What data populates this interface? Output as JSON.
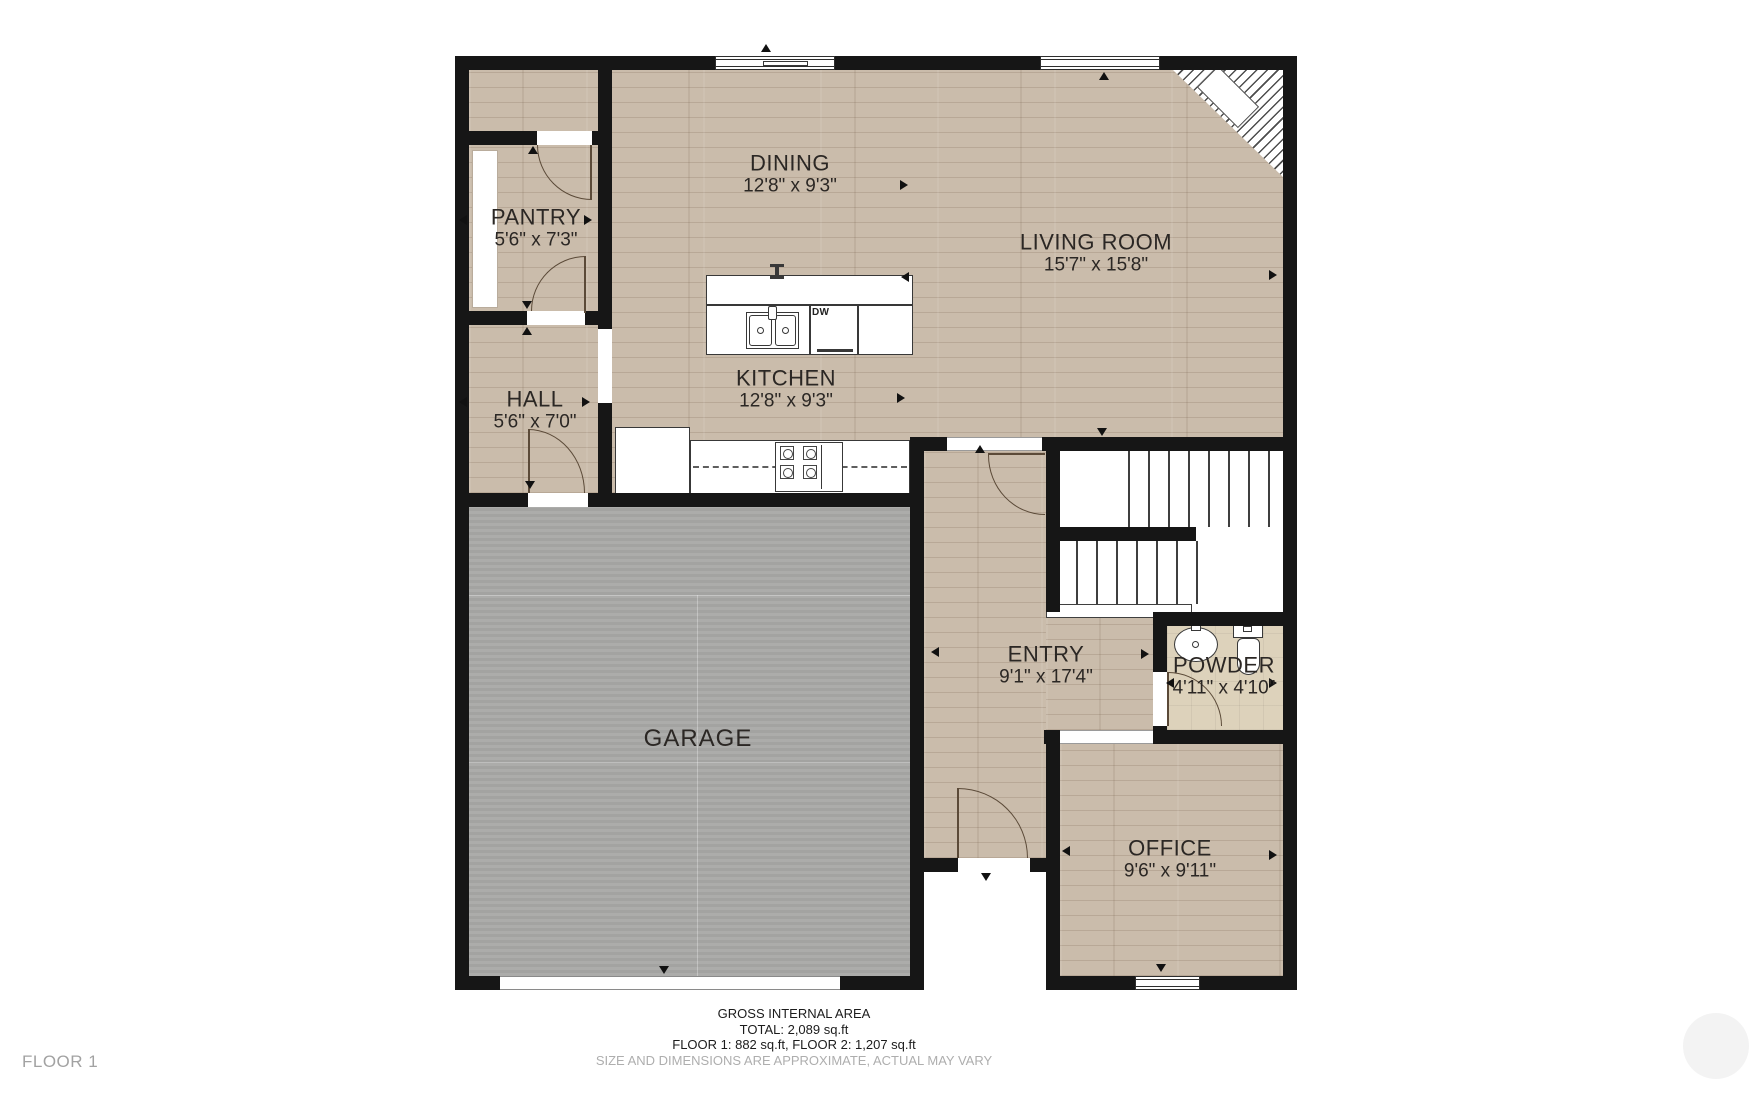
{
  "plan": {
    "floor_label": "FLOOR 1",
    "rooms": {
      "pantry": {
        "name": "PANTRY",
        "dims": "5'6\" x 7'3\""
      },
      "hall": {
        "name": "HALL",
        "dims": "5'6\" x 7'0\""
      },
      "dining": {
        "name": "DINING",
        "dims": "12'8\" x 9'3\""
      },
      "kitchen": {
        "name": "KITCHEN",
        "dims": "12'8\" x 9'3\""
      },
      "living": {
        "name": "LIVING ROOM",
        "dims": "15'7\" x 15'8\""
      },
      "garage": {
        "name": "GARAGE",
        "dims": ""
      },
      "entry": {
        "name": "ENTRY",
        "dims": "9'1\" x 17'4\""
      },
      "powder": {
        "name": "POWDER",
        "dims": "4'11\" x 4'10\""
      },
      "office": {
        "name": "OFFICE",
        "dims": "9'6\" x 9'11\""
      }
    },
    "appliances": {
      "dishwasher_label": "DW"
    },
    "footer": {
      "line1": "GROSS INTERNAL AREA",
      "line2": "TOTAL: 2,089 sq.ft",
      "line3": "FLOOR 1: 882 sq.ft, FLOOR 2: 1,207 sq.ft",
      "line4": "SIZE AND DIMENSIONS ARE APPROXIMATE, ACTUAL MAY VARY"
    },
    "colors": {
      "wall": "#161616",
      "wood_floor": "#cabcab",
      "garage_floor": "#a8a8a6",
      "powder_floor": "#ddd2bb",
      "door_arc": "#5b4a38",
      "label_text": "#2b2724",
      "muted_text": "#aeaeae"
    }
  }
}
